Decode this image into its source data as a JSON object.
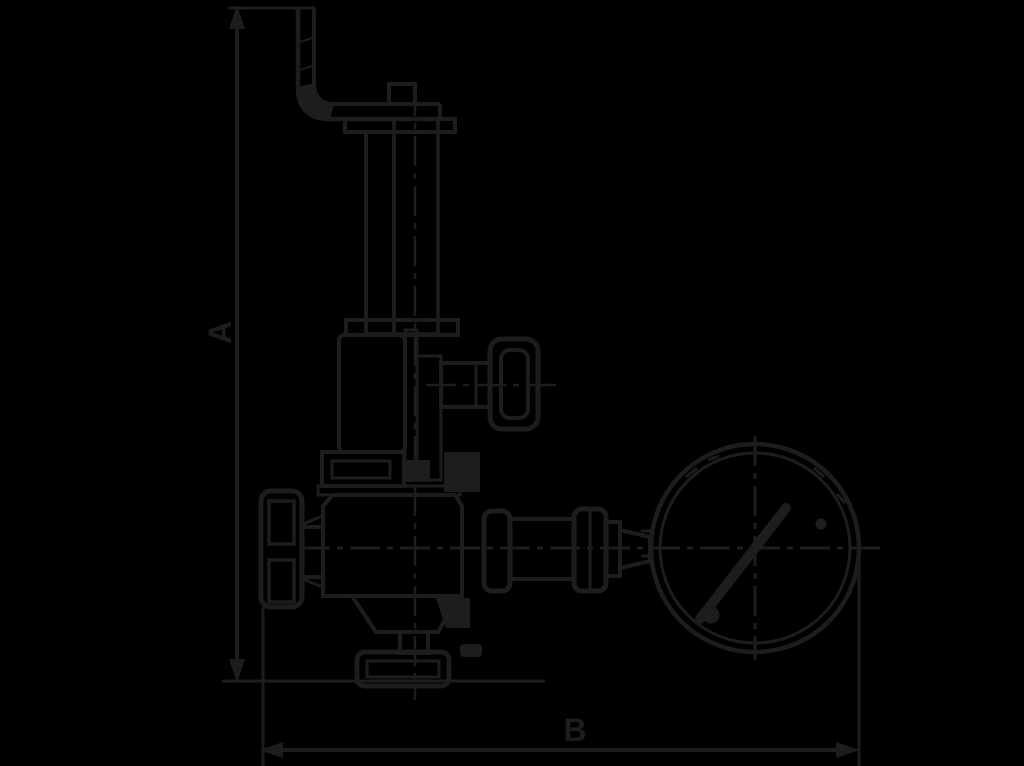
{
  "colors": {
    "background": "#000000",
    "line": "#1d1d1d"
  },
  "diagram": {
    "type": "technical-line-drawing",
    "subject": "safety relief valve with test lever, handwheel and pressure gauge",
    "dimension_labels": {
      "vertical": "A",
      "horizontal": "B"
    }
  }
}
